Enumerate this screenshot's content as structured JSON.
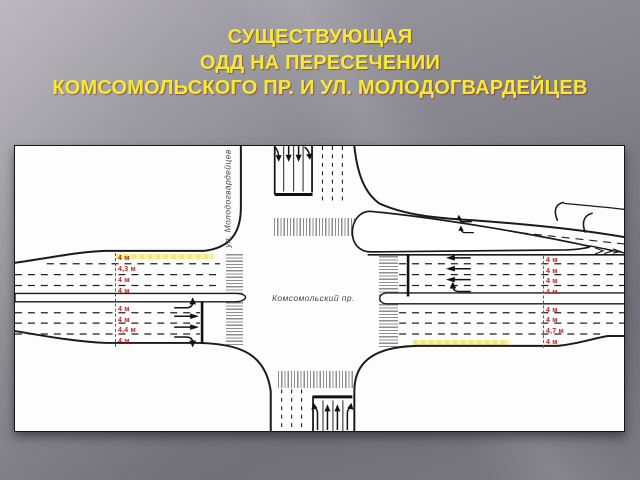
{
  "title": {
    "line1": "СУЩЕСТВУЮЩАЯ",
    "line2": "ОДД НА ПЕРЕСЕЧЕНИИ",
    "line3": "КОМСОМОЛЬСКОГО ПР. И УЛ. МОЛОДОГВАРДЕЙЦЕВ"
  },
  "colors": {
    "title_text": "#f3ea33",
    "dimension_text": "#c32222",
    "lane_highlight": "#f6ee8e",
    "road_line": "#1a1a1a",
    "crosswalk": "#8f8f8f",
    "panel_background": "#fdfdfd",
    "slide_background": "#7c7a82"
  },
  "diagram": {
    "street_horizontal": "Комсомольский пр.",
    "street_vertical": "ул. Молодогвардейцев",
    "dimensions": {
      "west_top": [
        "4 м",
        "4,3 м",
        "4 м",
        "4 м"
      ],
      "west_bottom": [
        "4 м",
        "4 м",
        "4,4 м",
        "4 м"
      ],
      "east_top": [
        "4 м",
        "4 м",
        "4 м",
        "4 м"
      ],
      "east_bottom": [
        "4 м",
        "4 м",
        "4,7 м",
        "4 м"
      ]
    }
  }
}
